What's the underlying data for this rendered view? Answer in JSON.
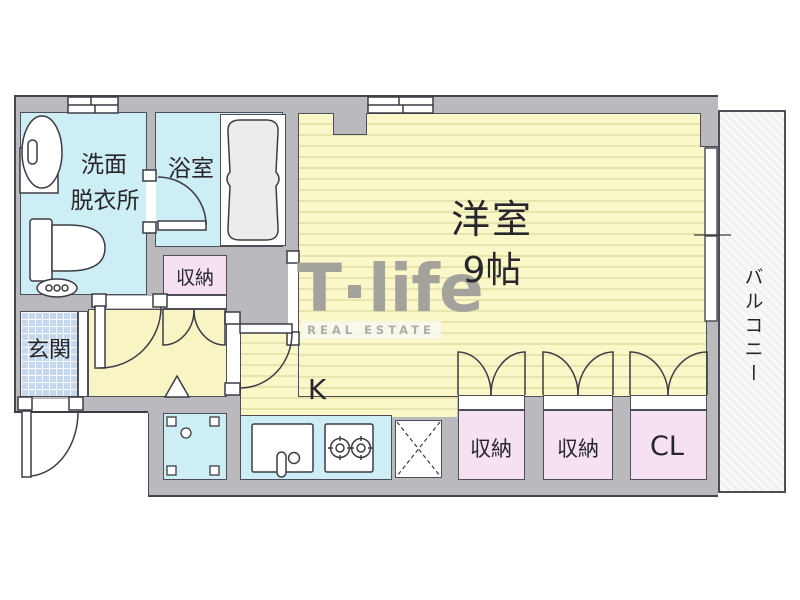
{
  "labels": {
    "washroom_1": "洗面",
    "washroom_2": "脱衣所",
    "bathroom": "浴室",
    "hall_storage": "収納",
    "entrance": "玄関",
    "kitchen": "K",
    "main_room": "洋室",
    "main_room_size": "9帖",
    "closet_1": "収納",
    "closet_2": "収納",
    "closet_3": "CL",
    "balcony": "バルコニー"
  },
  "watermark": {
    "brand_t": "T",
    "brand_rest": "life",
    "tagline": "REAL ESTATE"
  },
  "colors": {
    "wall": "#b9b9be",
    "outline": "#46464c",
    "line": "#4e4e56",
    "stroke": "#3c3c44",
    "room-cyan": "#cdeef4",
    "yellow-base": "#faf7c9",
    "yellow-line": "#e8e4ad",
    "hall-yellow": "#f8f4c4",
    "pink": "#f6e1f3",
    "tile-blue": "#c5d8ee",
    "balcony-bg": "#f8f8f8",
    "watermark": "#a3a39c"
  }
}
